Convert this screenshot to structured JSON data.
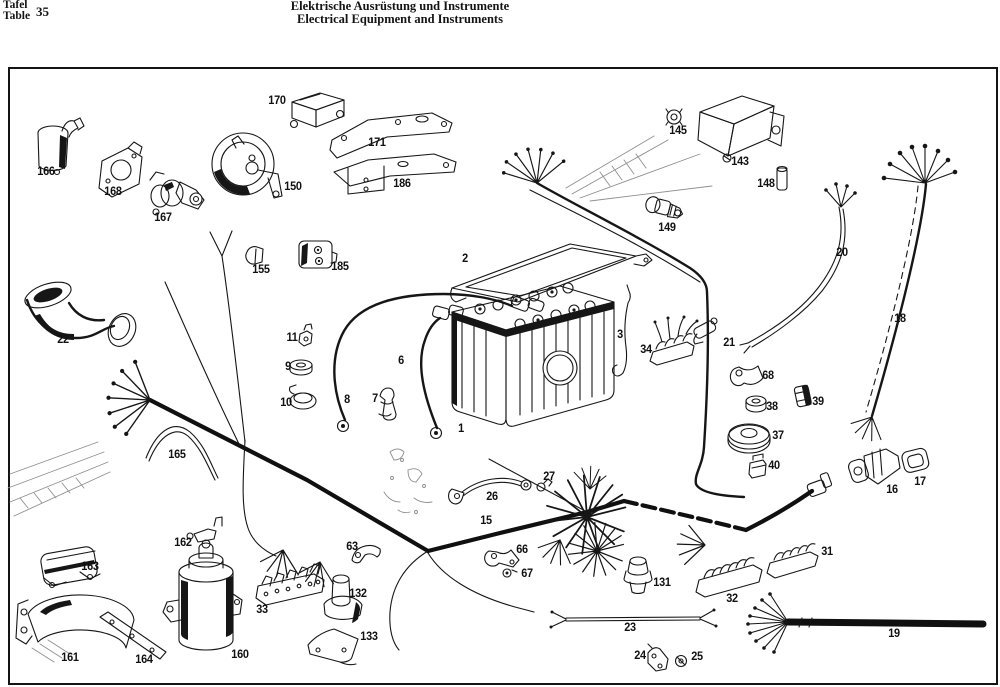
{
  "header": {
    "tafel_label": "Tafel",
    "table_label": "Table",
    "table_number": "35",
    "title_de": "Elektrische Ausrüstung und Instrumente",
    "title_en": "Electrical Equipment and Instruments"
  },
  "colors": {
    "ink": "#141414",
    "paper": "#ffffff",
    "ghost": "#8f8f8f"
  },
  "diagram": {
    "labels": [
      {
        "n": "166",
        "x": 46,
        "y": 172
      },
      {
        "n": "168",
        "x": 113,
        "y": 192
      },
      {
        "n": "167",
        "x": 163,
        "y": 218
      },
      {
        "n": "170",
        "x": 277,
        "y": 101
      },
      {
        "n": "171",
        "x": 377,
        "y": 143
      },
      {
        "n": "150",
        "x": 293,
        "y": 187
      },
      {
        "n": "186",
        "x": 402,
        "y": 184
      },
      {
        "n": "155",
        "x": 261,
        "y": 270
      },
      {
        "n": "185",
        "x": 340,
        "y": 267
      },
      {
        "n": "22",
        "x": 63,
        "y": 340
      },
      {
        "n": "165",
        "x": 177,
        "y": 455
      },
      {
        "n": "11",
        "x": 292,
        "y": 338
      },
      {
        "n": "9",
        "x": 288,
        "y": 367
      },
      {
        "n": "10",
        "x": 286,
        "y": 403
      },
      {
        "n": "8",
        "x": 347,
        "y": 400
      },
      {
        "n": "7",
        "x": 375,
        "y": 399
      },
      {
        "n": "6",
        "x": 401,
        "y": 361
      },
      {
        "n": "2",
        "x": 465,
        "y": 259
      },
      {
        "n": "1",
        "x": 461,
        "y": 429
      },
      {
        "n": "3",
        "x": 620,
        "y": 335
      },
      {
        "n": "34",
        "x": 646,
        "y": 350
      },
      {
        "n": "145",
        "x": 678,
        "y": 131
      },
      {
        "n": "143",
        "x": 740,
        "y": 162
      },
      {
        "n": "148",
        "x": 766,
        "y": 184
      },
      {
        "n": "149",
        "x": 667,
        "y": 228
      },
      {
        "n": "20",
        "x": 842,
        "y": 253
      },
      {
        "n": "21",
        "x": 729,
        "y": 343
      },
      {
        "n": "18",
        "x": 900,
        "y": 319
      },
      {
        "n": "68",
        "x": 768,
        "y": 376
      },
      {
        "n": "38",
        "x": 772,
        "y": 407
      },
      {
        "n": "39",
        "x": 818,
        "y": 402
      },
      {
        "n": "37",
        "x": 778,
        "y": 436
      },
      {
        "n": "40",
        "x": 774,
        "y": 466
      },
      {
        "n": "16",
        "x": 892,
        "y": 490
      },
      {
        "n": "17",
        "x": 920,
        "y": 482
      },
      {
        "n": "162",
        "x": 183,
        "y": 543
      },
      {
        "n": "163",
        "x": 90,
        "y": 567
      },
      {
        "n": "161",
        "x": 70,
        "y": 658
      },
      {
        "n": "164",
        "x": 144,
        "y": 660
      },
      {
        "n": "160",
        "x": 240,
        "y": 655
      },
      {
        "n": "33",
        "x": 262,
        "y": 610
      },
      {
        "n": "63",
        "x": 352,
        "y": 547
      },
      {
        "n": "132",
        "x": 358,
        "y": 594
      },
      {
        "n": "133",
        "x": 369,
        "y": 637
      },
      {
        "n": "26",
        "x": 492,
        "y": 497
      },
      {
        "n": "27",
        "x": 549,
        "y": 477
      },
      {
        "n": "15",
        "x": 486,
        "y": 521
      },
      {
        "n": "66",
        "x": 522,
        "y": 550
      },
      {
        "n": "67",
        "x": 527,
        "y": 574
      },
      {
        "n": "131",
        "x": 662,
        "y": 583
      },
      {
        "n": "23",
        "x": 630,
        "y": 628
      },
      {
        "n": "24",
        "x": 640,
        "y": 656
      },
      {
        "n": "25",
        "x": 697,
        "y": 657
      },
      {
        "n": "32",
        "x": 732,
        "y": 599
      },
      {
        "n": "31",
        "x": 827,
        "y": 552
      },
      {
        "n": "19",
        "x": 894,
        "y": 634
      }
    ]
  }
}
